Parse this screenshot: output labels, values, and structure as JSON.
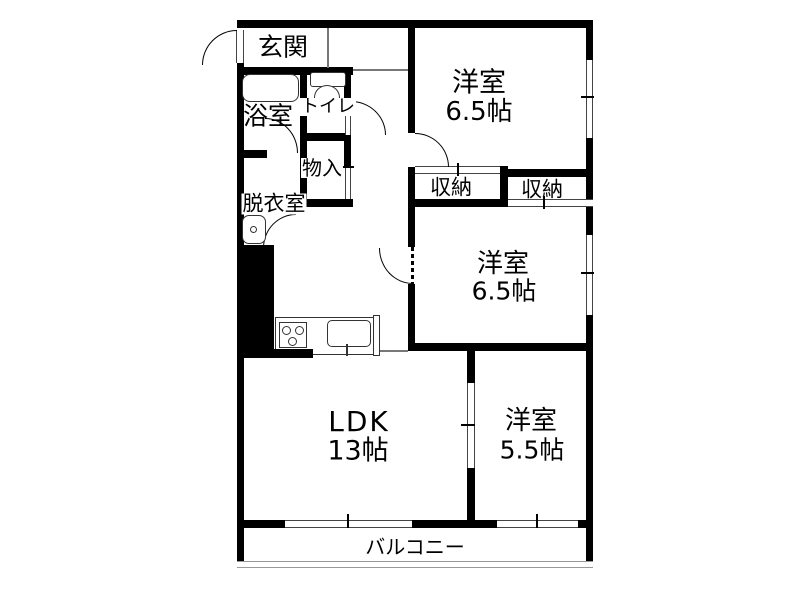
{
  "rooms": {
    "genkan": {
      "label": "玄関"
    },
    "bathroom": {
      "label": "浴室"
    },
    "toilet": {
      "label": "トイレ"
    },
    "hall_storage": {
      "label": "物入"
    },
    "dressing_room": {
      "label": "脱衣室"
    },
    "bedroom_top": {
      "label": "洋室",
      "size": "6.5帖"
    },
    "closet_left": {
      "label": "収納"
    },
    "closet_right": {
      "label": "収納"
    },
    "bedroom_mid": {
      "label": "洋室",
      "size": "6.5帖"
    },
    "ldk": {
      "label": "LDK",
      "size": "13帖"
    },
    "bedroom_small": {
      "label": "洋室",
      "size": "5.5帖"
    },
    "balcony": {
      "label": "バルコニー"
    }
  },
  "colors": {
    "wall": "#000000",
    "floor": "#ffffff",
    "window_line": "#555555"
  }
}
